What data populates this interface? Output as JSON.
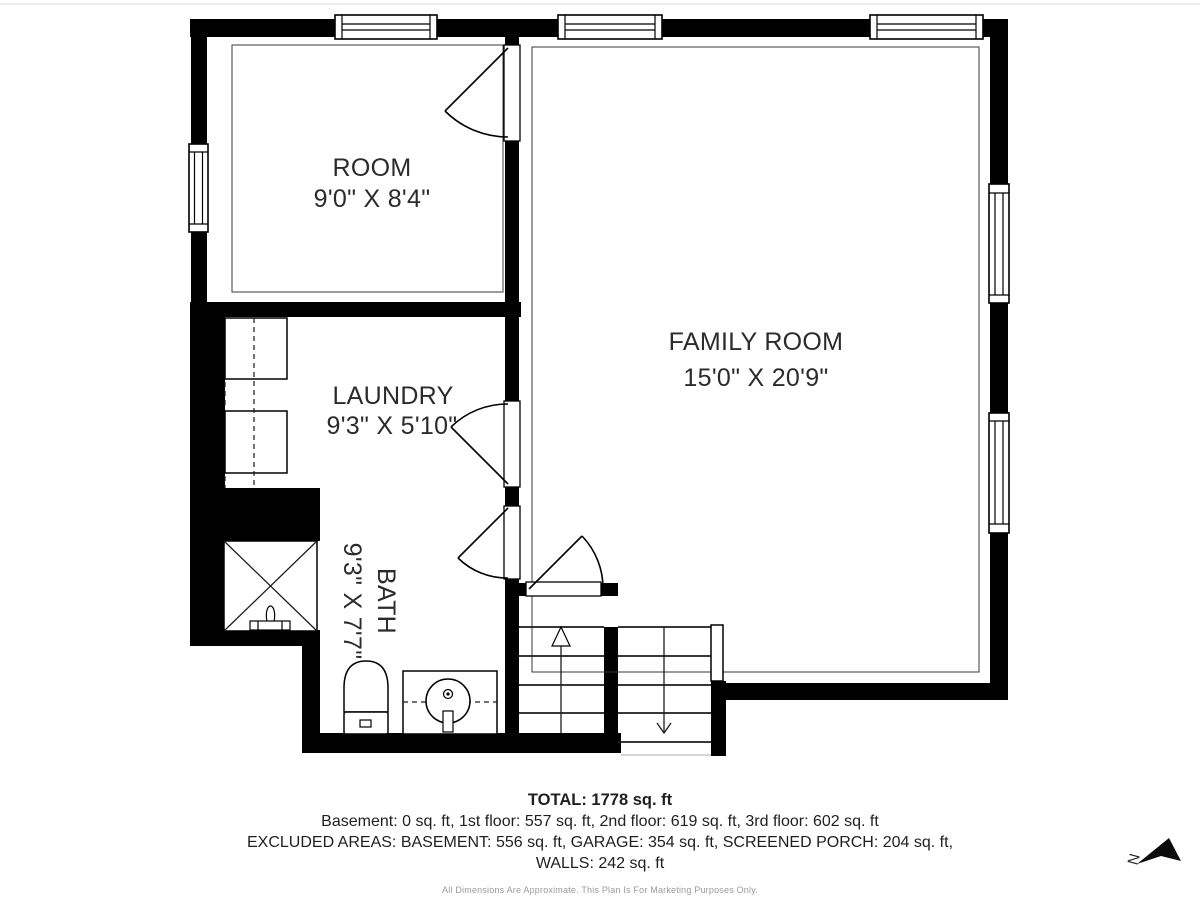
{
  "rooms": [
    {
      "name": "ROOM",
      "dims": "9'0\" X 8'4\""
    },
    {
      "name": "LAUNDRY",
      "dims": "9'3\" X 5'10\""
    },
    {
      "name": "BATH",
      "dims": "9'3\" X 7'7\""
    },
    {
      "name": "FAMILY ROOM",
      "dims": "15'0\" X 20'9\""
    }
  ],
  "summary": {
    "total": "TOTAL: 1778 sq. ft",
    "floors": "Basement: 0 sq. ft, 1st floor: 557 sq. ft, 2nd floor: 619 sq. ft, 3rd floor: 602 sq. ft",
    "excluded_areas": "EXCLUDED AREAS: BASEMENT: 556 sq. ft, GARAGE: 354 sq. ft, SCREENED PORCH: 204 sq. ft,",
    "walls": "WALLS: 242 sq. ft",
    "disclaimer": "All Dimensions Are Approximate. This Plan Is For Marketing Purposes Only."
  },
  "compass": {
    "north_label": "N"
  },
  "colors": {
    "walls": "#000000",
    "background": "#ffffff",
    "disclaimer_text": "#9a9a9a"
  }
}
